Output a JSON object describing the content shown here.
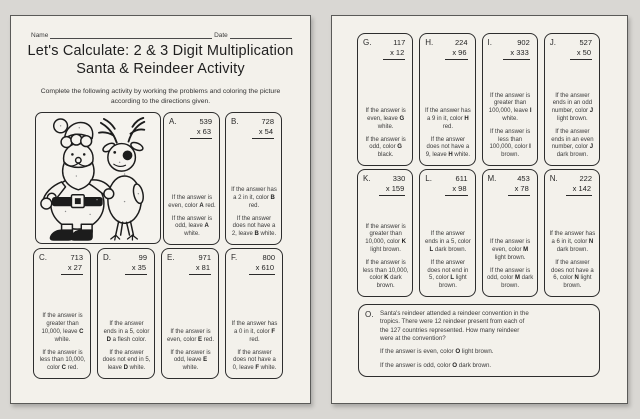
{
  "colors": {
    "background": "#d9d7d3",
    "paper": "#f3f1eb",
    "ink": "#2c2c2c"
  },
  "left_page": {
    "name_label": "Name",
    "date_label": "Date",
    "title_line1": "Let's Calculate: 2 & 3 Digit Multiplication",
    "title_line2": "Santa & Reindeer Activity",
    "instructions": "Complete the following activity by working the problems and coloring the picture according to the directions given.",
    "illustration": "santa-and-reindeer-coloring-line-art",
    "top_row_problems": [
      {
        "letter": "A.",
        "multiplicand": "539",
        "multiplier": "x 63",
        "directions": [
          {
            "pre": "If the answer is even, color ",
            "bold": "A",
            "post": " red."
          },
          {
            "pre": "If the answer is odd, leave ",
            "bold": "A",
            "post": " white."
          }
        ]
      },
      {
        "letter": "B.",
        "multiplicand": "728",
        "multiplier": "x 54",
        "directions": [
          {
            "pre": "If the answer has a 2 in it, color ",
            "bold": "B",
            "post": " red."
          },
          {
            "pre": "If the answer does not have a 2, leave ",
            "bold": "B",
            "post": " white."
          }
        ]
      }
    ],
    "bottom_row_problems": [
      {
        "letter": "C.",
        "multiplicand": "713",
        "multiplier": "x 27",
        "directions": [
          {
            "pre": "If the answer is greater than 10,000, leave ",
            "bold": "C",
            "post": " white."
          },
          {
            "pre": "If the answer is less than 10,000, color ",
            "bold": "C",
            "post": " red."
          }
        ]
      },
      {
        "letter": "D.",
        "multiplicand": "99",
        "multiplier": "x 35",
        "directions": [
          {
            "pre": "If the answer ends in a 5, color ",
            "bold": "D",
            "post": " a flesh color."
          },
          {
            "pre": "If the answer does not end in 5, leave ",
            "bold": "D",
            "post": " white."
          }
        ]
      },
      {
        "letter": "E.",
        "multiplicand": "971",
        "multiplier": "x 81",
        "directions": [
          {
            "pre": "If the answer is even, color ",
            "bold": "E",
            "post": " red."
          },
          {
            "pre": "If the answer is odd, leave ",
            "bold": "E",
            "post": " white."
          }
        ]
      },
      {
        "letter": "F.",
        "multiplicand": "800",
        "multiplier": "x 610",
        "directions": [
          {
            "pre": "If the answer has a 0 in it, color ",
            "bold": "F",
            "post": " red."
          },
          {
            "pre": "If the answer does not have a 0, leave ",
            "bold": "F",
            "post": " white."
          }
        ]
      }
    ]
  },
  "right_page": {
    "row1_problems": [
      {
        "letter": "G.",
        "multiplicand": "117",
        "multiplier": "x 12",
        "directions": [
          {
            "pre": "If the answer is even, leave ",
            "bold": "G",
            "post": " white."
          },
          {
            "pre": "If the answer is odd, color ",
            "bold": "G",
            "post": " black."
          }
        ]
      },
      {
        "letter": "H.",
        "multiplicand": "224",
        "multiplier": "x 96",
        "directions": [
          {
            "pre": "If the answer has a 9 in it, color ",
            "bold": "H",
            "post": " red."
          },
          {
            "pre": "If the answer does not have a 9, leave ",
            "bold": "H",
            "post": " white."
          }
        ]
      },
      {
        "letter": "I.",
        "multiplicand": "902",
        "multiplier": "x 333",
        "directions": [
          {
            "pre": "If the answer is greater than 100,000, leave ",
            "bold": "I",
            "post": " white."
          },
          {
            "pre": "If the answer is less than 100,000, color ",
            "bold": "I",
            "post": " brown."
          }
        ]
      },
      {
        "letter": "J.",
        "multiplicand": "527",
        "multiplier": "x 50",
        "directions": [
          {
            "pre": "If the answer ends in an odd number, color ",
            "bold": "J",
            "post": " light brown."
          },
          {
            "pre": "If the answer ends in an even number, color ",
            "bold": "J",
            "post": " dark brown."
          }
        ]
      }
    ],
    "row2_problems": [
      {
        "letter": "K.",
        "multiplicand": "330",
        "multiplier": "x 159",
        "directions": [
          {
            "pre": "If the answer is greater than 10,000, color ",
            "bold": "K",
            "post": " light brown."
          },
          {
            "pre": "If the answer is less than 10,000, color ",
            "bold": "K",
            "post": " dark brown."
          }
        ]
      },
      {
        "letter": "L.",
        "multiplicand": "611",
        "multiplier": "x 98",
        "directions": [
          {
            "pre": "If the answer ends in a 5, color ",
            "bold": "L",
            "post": " dark brown."
          },
          {
            "pre": "If the answer does not end in 5, color ",
            "bold": "L",
            "post": " light brown."
          }
        ]
      },
      {
        "letter": "M.",
        "multiplicand": "453",
        "multiplier": "x 78",
        "directions": [
          {
            "pre": "If the answer is even, color ",
            "bold": "M",
            "post": " light brown."
          },
          {
            "pre": "If the answer is odd, color ",
            "bold": "M",
            "post": " dark brown."
          }
        ]
      },
      {
        "letter": "N.",
        "multiplicand": "222",
        "multiplier": "x 142",
        "directions": [
          {
            "pre": "If the answer has a 6 in it, color ",
            "bold": "N",
            "post": " dark brown."
          },
          {
            "pre": "If the answer does not have a 6, color ",
            "bold": "N",
            "post": " light brown."
          }
        ]
      }
    ],
    "word_problem": {
      "letter": "O.",
      "text": "Santa's reindeer attended a reindeer convention in the tropics. There were 12 reindeer present from each of the 127 countries represented. How many reindeer were at the convention?",
      "directions": [
        {
          "pre": "If the answer is even, color ",
          "bold": "O",
          "post": " light brown."
        },
        {
          "pre": "If the answer is odd, color ",
          "bold": "O",
          "post": " dark brown."
        }
      ]
    }
  }
}
